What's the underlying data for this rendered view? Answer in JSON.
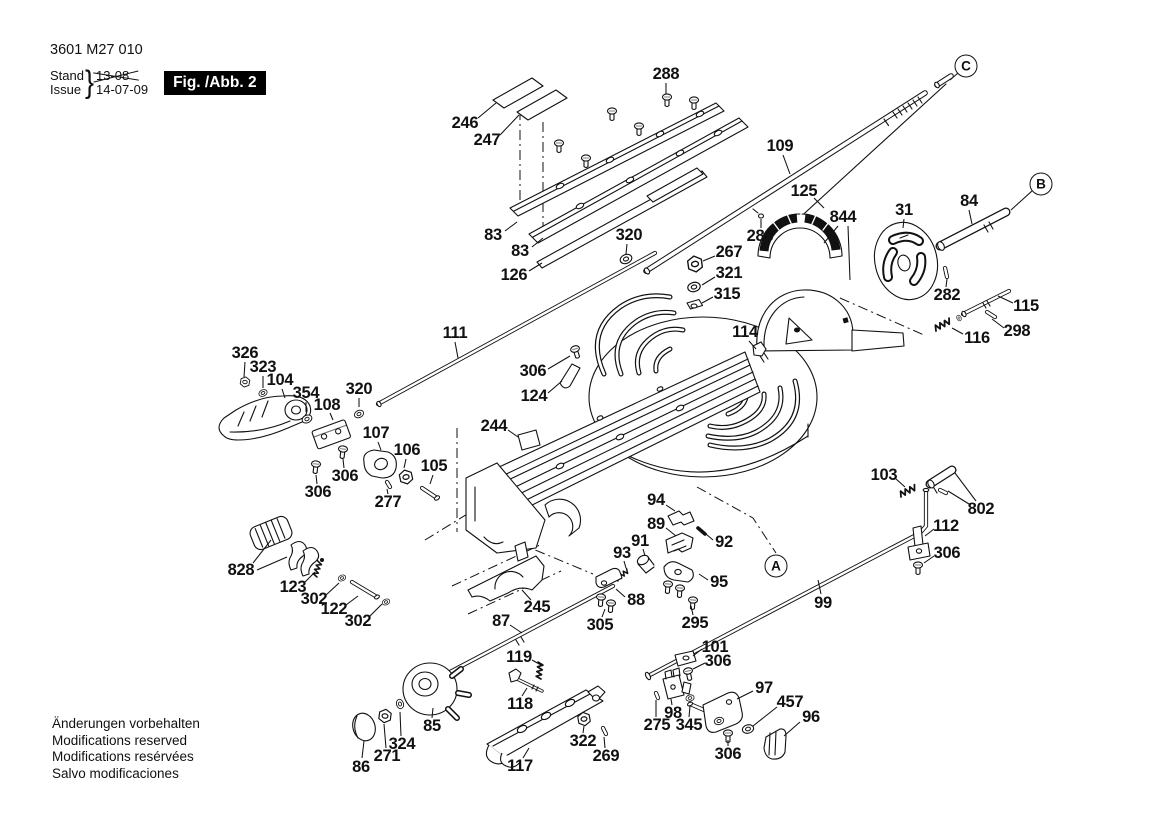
{
  "title_block": {
    "part_number": "3601 M27 010",
    "stand_label": "Stand",
    "issue_label": "Issue",
    "old_date": "13-08",
    "date": "14-07-09",
    "figure_label": "Fig. /Abb. 2"
  },
  "footer_notes": {
    "line1": "Änderungen vorbehalten",
    "line2": "Modifications reserved",
    "line3": "Modifications resérvées",
    "line4": "Salvo modificaciones"
  },
  "ref_circles": [
    {
      "label": "A",
      "x": 776,
      "y": 566,
      "leaders": []
    },
    {
      "label": "B",
      "x": 1041,
      "y": 184,
      "leaders": [
        [
          [
            1032,
            191
          ],
          [
            1011,
            210
          ]
        ]
      ]
    },
    {
      "label": "C",
      "x": 966,
      "y": 66,
      "leaders": [
        [
          [
            958,
            73
          ],
          [
            950,
            80
          ]
        ]
      ]
    }
  ],
  "part_labels": [
    {
      "text": "288",
      "x": 666,
      "y": 74,
      "leaders": [
        [
          [
            666,
            83
          ],
          [
            666,
            94
          ]
        ]
      ]
    },
    {
      "text": "246",
      "x": 465,
      "y": 123,
      "leaders": [
        [
          [
            478,
            118
          ],
          [
            496,
            103
          ]
        ]
      ]
    },
    {
      "text": "247",
      "x": 487,
      "y": 140,
      "leaders": [
        [
          [
            500,
            135
          ],
          [
            519,
            115
          ]
        ]
      ]
    },
    {
      "text": "109",
      "x": 780,
      "y": 146,
      "leaders": [
        [
          [
            783,
            155
          ],
          [
            790,
            174
          ]
        ]
      ]
    },
    {
      "text": "125",
      "x": 804,
      "y": 191,
      "leaders": [
        [
          [
            814,
            198
          ],
          [
            824,
            208
          ]
        ]
      ]
    },
    {
      "text": "844",
      "x": 843,
      "y": 217,
      "leaders": [
        [
          [
            838,
            226
          ],
          [
            824,
            243
          ]
        ],
        [
          [
            848,
            226
          ],
          [
            850,
            280
          ]
        ]
      ]
    },
    {
      "text": "31",
      "x": 904,
      "y": 210,
      "leaders": [
        [
          [
            904,
            219
          ],
          [
            903,
            228
          ]
        ]
      ]
    },
    {
      "text": "84",
      "x": 969,
      "y": 201,
      "leaders": [
        [
          [
            969,
            210
          ],
          [
            972,
            224
          ]
        ]
      ]
    },
    {
      "text": "283",
      "x": 760,
      "y": 236,
      "leaders": [
        [
          [
            761,
            228
          ],
          [
            761,
            219
          ]
        ]
      ]
    },
    {
      "text": "83",
      "x": 493,
      "y": 235,
      "leaders": [
        [
          [
            505,
            231
          ],
          [
            517,
            222
          ]
        ]
      ]
    },
    {
      "text": "83",
      "x": 520,
      "y": 251,
      "leaders": [
        [
          [
            532,
            247
          ],
          [
            543,
            238
          ]
        ]
      ]
    },
    {
      "text": "320",
      "x": 629,
      "y": 235,
      "leaders": [
        [
          [
            627,
            244
          ],
          [
            626,
            254
          ]
        ]
      ]
    },
    {
      "text": "126",
      "x": 514,
      "y": 275,
      "leaders": [
        [
          [
            529,
            271
          ],
          [
            542,
            263
          ]
        ]
      ]
    },
    {
      "text": "267",
      "x": 729,
      "y": 252,
      "leaders": [
        [
          [
            715,
            256
          ],
          [
            703,
            261
          ]
        ]
      ]
    },
    {
      "text": "321",
      "x": 729,
      "y": 273,
      "leaders": [
        [
          [
            715,
            277
          ],
          [
            702,
            285
          ]
        ]
      ]
    },
    {
      "text": "315",
      "x": 727,
      "y": 294,
      "leaders": [
        [
          [
            713,
            297
          ],
          [
            702,
            303
          ]
        ]
      ]
    },
    {
      "text": "282",
      "x": 947,
      "y": 295,
      "leaders": [
        [
          [
            946,
            287
          ],
          [
            947,
            279
          ]
        ]
      ]
    },
    {
      "text": "115",
      "x": 1026,
      "y": 306,
      "leaders": [
        [
          [
            1013,
            303
          ],
          [
            998,
            296
          ]
        ]
      ]
    },
    {
      "text": "298",
      "x": 1017,
      "y": 331,
      "leaders": [
        [
          [
            1004,
            328
          ],
          [
            992,
            319
          ]
        ]
      ]
    },
    {
      "text": "116",
      "x": 977,
      "y": 338,
      "leaders": [
        [
          [
            963,
            334
          ],
          [
            952,
            328
          ]
        ]
      ]
    },
    {
      "text": "111",
      "x": 455,
      "y": 333,
      "leaders": [
        [
          [
            455,
            342
          ],
          [
            458,
            358
          ]
        ]
      ]
    },
    {
      "text": "114",
      "x": 745,
      "y": 332,
      "leaders": [
        [
          [
            749,
            341
          ],
          [
            756,
            349
          ]
        ]
      ]
    },
    {
      "text": "306",
      "x": 533,
      "y": 371,
      "leaders": [
        [
          [
            548,
            369
          ],
          [
            570,
            356
          ]
        ]
      ]
    },
    {
      "text": "124",
      "x": 534,
      "y": 396,
      "leaders": [
        [
          [
            548,
            393
          ],
          [
            562,
            381
          ]
        ]
      ]
    },
    {
      "text": "326",
      "x": 245,
      "y": 353,
      "leaders": [
        [
          [
            245,
            362
          ],
          [
            244,
            377
          ]
        ]
      ]
    },
    {
      "text": "323",
      "x": 263,
      "y": 367,
      "leaders": [
        [
          [
            263,
            376
          ],
          [
            263,
            388
          ]
        ]
      ]
    },
    {
      "text": "104",
      "x": 280,
      "y": 380,
      "leaders": [
        [
          [
            282,
            389
          ],
          [
            285,
            398
          ]
        ]
      ]
    },
    {
      "text": "354",
      "x": 306,
      "y": 393,
      "leaders": [
        [
          [
            306,
            402
          ],
          [
            306,
            412
          ]
        ]
      ]
    },
    {
      "text": "108",
      "x": 327,
      "y": 405,
      "leaders": [
        [
          [
            330,
            413
          ],
          [
            333,
            420
          ]
        ]
      ]
    },
    {
      "text": "320",
      "x": 359,
      "y": 389,
      "leaders": [
        [
          [
            359,
            398
          ],
          [
            359,
            407
          ]
        ]
      ]
    },
    {
      "text": "107",
      "x": 376,
      "y": 433,
      "leaders": [
        [
          [
            378,
            442
          ],
          [
            381,
            450
          ]
        ]
      ]
    },
    {
      "text": "106",
      "x": 407,
      "y": 450,
      "leaders": [
        [
          [
            406,
            459
          ],
          [
            404,
            468
          ]
        ]
      ]
    },
    {
      "text": "105",
      "x": 434,
      "y": 466,
      "leaders": [
        [
          [
            433,
            475
          ],
          [
            430,
            484
          ]
        ]
      ]
    },
    {
      "text": "244",
      "x": 494,
      "y": 426,
      "leaders": [
        [
          [
            508,
            430
          ],
          [
            518,
            437
          ]
        ]
      ]
    },
    {
      "text": "306",
      "x": 345,
      "y": 476,
      "leaders": [
        [
          [
            344,
            468
          ],
          [
            343,
            459
          ]
        ]
      ]
    },
    {
      "text": "306",
      "x": 318,
      "y": 492,
      "leaders": [
        [
          [
            317,
            484
          ],
          [
            316,
            475
          ]
        ]
      ]
    },
    {
      "text": "277",
      "x": 388,
      "y": 502,
      "leaders": [
        [
          [
            388,
            494
          ],
          [
            387,
            489
          ]
        ]
      ]
    },
    {
      "text": "828",
      "x": 241,
      "y": 570,
      "leaders": [
        [
          [
            253,
            563
          ],
          [
            271,
            540
          ]
        ],
        [
          [
            257,
            570
          ],
          [
            287,
            557
          ]
        ]
      ]
    },
    {
      "text": "123",
      "x": 293,
      "y": 587,
      "leaders": [
        [
          [
            304,
            583
          ],
          [
            315,
            572
          ]
        ]
      ]
    },
    {
      "text": "302",
      "x": 314,
      "y": 599,
      "leaders": [
        [
          [
            326,
            595
          ],
          [
            339,
            583
          ]
        ]
      ]
    },
    {
      "text": "122",
      "x": 334,
      "y": 609,
      "leaders": [
        [
          [
            346,
            605
          ],
          [
            358,
            596
          ]
        ]
      ]
    },
    {
      "text": "302",
      "x": 358,
      "y": 621,
      "leaders": [
        [
          [
            369,
            617
          ],
          [
            382,
            604
          ]
        ]
      ]
    },
    {
      "text": "87",
      "x": 501,
      "y": 621,
      "leaders": [
        [
          [
            510,
            625
          ],
          [
            522,
            633
          ]
        ]
      ]
    },
    {
      "text": "245",
      "x": 537,
      "y": 607,
      "leaders": [
        [
          [
            531,
            600
          ],
          [
            522,
            590
          ]
        ]
      ]
    },
    {
      "text": "94",
      "x": 656,
      "y": 500,
      "leaders": [
        [
          [
            666,
            505
          ],
          [
            675,
            511
          ]
        ]
      ]
    },
    {
      "text": "89",
      "x": 656,
      "y": 524,
      "leaders": [
        [
          [
            666,
            528
          ],
          [
            676,
            536
          ]
        ]
      ]
    },
    {
      "text": "92",
      "x": 724,
      "y": 542,
      "leaders": [
        [
          [
            713,
            540
          ],
          [
            706,
            534
          ]
        ]
      ]
    },
    {
      "text": "91",
      "x": 640,
      "y": 541,
      "leaders": [
        [
          [
            643,
            549
          ],
          [
            645,
            556
          ]
        ]
      ]
    },
    {
      "text": "93",
      "x": 622,
      "y": 553,
      "leaders": [
        [
          [
            624,
            561
          ],
          [
            626,
            568
          ]
        ]
      ]
    },
    {
      "text": "95",
      "x": 719,
      "y": 582,
      "leaders": [
        [
          [
            708,
            580
          ],
          [
            699,
            574
          ]
        ]
      ]
    },
    {
      "text": "88",
      "x": 636,
      "y": 600,
      "leaders": [
        [
          [
            625,
            597
          ],
          [
            616,
            589
          ]
        ]
      ]
    },
    {
      "text": "305",
      "x": 600,
      "y": 625,
      "leaders": [
        [
          [
            602,
            617
          ],
          [
            605,
            609
          ]
        ]
      ]
    },
    {
      "text": "295",
      "x": 695,
      "y": 623,
      "leaders": [
        [
          [
            693,
            615
          ],
          [
            691,
            606
          ]
        ]
      ]
    },
    {
      "text": "99",
      "x": 823,
      "y": 603,
      "leaders": [
        [
          [
            821,
            594
          ],
          [
            818,
            580
          ]
        ]
      ]
    },
    {
      "text": "103",
      "x": 884,
      "y": 475,
      "leaders": [
        [
          [
            896,
            479
          ],
          [
            905,
            487
          ]
        ]
      ]
    },
    {
      "text": "802",
      "x": 981,
      "y": 509,
      "leaders": [
        [
          [
            969,
            504
          ],
          [
            948,
            491
          ]
        ],
        [
          [
            976,
            501
          ],
          [
            955,
            473
          ]
        ]
      ]
    },
    {
      "text": "112",
      "x": 946,
      "y": 526,
      "leaders": [
        [
          [
            934,
            529
          ],
          [
            925,
            536
          ]
        ]
      ]
    },
    {
      "text": "306",
      "x": 947,
      "y": 553,
      "leaders": [
        [
          [
            934,
            556
          ],
          [
            924,
            563
          ]
        ]
      ]
    },
    {
      "text": "101",
      "x": 715,
      "y": 647,
      "leaders": [
        [
          [
            702,
            649
          ],
          [
            693,
            656
          ]
        ]
      ]
    },
    {
      "text": "306",
      "x": 718,
      "y": 661,
      "leaders": [
        [
          [
            705,
            663
          ],
          [
            693,
            669
          ]
        ]
      ]
    },
    {
      "text": "119",
      "x": 519,
      "y": 657,
      "leaders": [
        [
          [
            532,
            660
          ],
          [
            541,
            665
          ]
        ]
      ]
    },
    {
      "text": "118",
      "x": 520,
      "y": 704,
      "leaders": [
        [
          [
            522,
            696
          ],
          [
            527,
            688
          ]
        ]
      ]
    },
    {
      "text": "85",
      "x": 432,
      "y": 726,
      "leaders": [
        [
          [
            432,
            718
          ],
          [
            433,
            708
          ]
        ]
      ]
    },
    {
      "text": "324",
      "x": 402,
      "y": 744,
      "leaders": [
        [
          [
            401,
            736
          ],
          [
            400,
            712
          ]
        ]
      ]
    },
    {
      "text": "271",
      "x": 387,
      "y": 756,
      "leaders": [
        [
          [
            386,
            748
          ],
          [
            384,
            724
          ]
        ]
      ]
    },
    {
      "text": "86",
      "x": 361,
      "y": 767,
      "leaders": [
        [
          [
            362,
            758
          ],
          [
            364,
            741
          ]
        ]
      ]
    },
    {
      "text": "117",
      "x": 520,
      "y": 766,
      "leaders": [
        [
          [
            523,
            758
          ],
          [
            529,
            748
          ]
        ]
      ]
    },
    {
      "text": "322",
      "x": 583,
      "y": 741,
      "leaders": [
        [
          [
            583,
            733
          ],
          [
            584,
            726
          ]
        ]
      ]
    },
    {
      "text": "269",
      "x": 606,
      "y": 756,
      "leaders": [
        [
          [
            605,
            748
          ],
          [
            604,
            737
          ]
        ]
      ]
    },
    {
      "text": "98",
      "x": 673,
      "y": 713,
      "leaders": [
        [
          [
            672,
            705
          ],
          [
            671,
            699
          ]
        ]
      ]
    },
    {
      "text": "275",
      "x": 657,
      "y": 725,
      "leaders": [
        [
          [
            656,
            717
          ],
          [
            656,
            700
          ]
        ]
      ]
    },
    {
      "text": "345",
      "x": 689,
      "y": 725,
      "leaders": [
        [
          [
            689,
            717
          ],
          [
            690,
            706
          ]
        ]
      ]
    },
    {
      "text": "97",
      "x": 764,
      "y": 688,
      "leaders": [
        [
          [
            753,
            691
          ],
          [
            737,
            699
          ]
        ]
      ]
    },
    {
      "text": "457",
      "x": 790,
      "y": 702,
      "leaders": [
        [
          [
            777,
            707
          ],
          [
            753,
            726
          ]
        ]
      ]
    },
    {
      "text": "96",
      "x": 811,
      "y": 717,
      "leaders": [
        [
          [
            800,
            722
          ],
          [
            784,
            736
          ]
        ]
      ]
    },
    {
      "text": "306",
      "x": 728,
      "y": 754,
      "leaders": [
        [
          [
            728,
            746
          ],
          [
            728,
            740
          ]
        ]
      ]
    }
  ]
}
